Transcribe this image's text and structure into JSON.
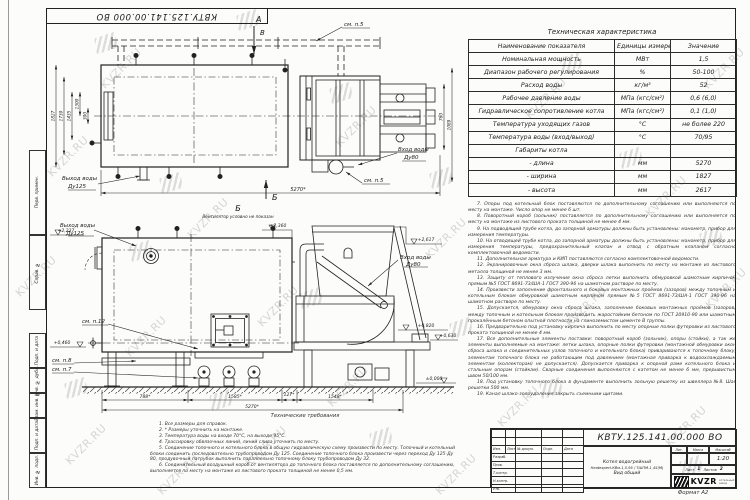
{
  "sheet": {
    "doc_number_top": "КВТУ.125.141.00.000 ВО",
    "format_note": "Формат А2"
  },
  "watermark": {
    "text": "KVZR.RU"
  },
  "margin_labels": [
    "Перв. примен.",
    "Справ. №",
    "Подп. и дата",
    "Инв. № дубл.",
    "Взам. инв. №",
    "Подп. и дата",
    "Инв. № подл."
  ],
  "spec_table": {
    "title": "Техническая характеристика",
    "headers": [
      "Наименование показателя",
      "Единицы измерения",
      "Значение"
    ],
    "rows": [
      [
        "Номинальная мощность",
        "МВт",
        "1,5"
      ],
      [
        "Диапазон рабочего регулирования",
        "%",
        "50-100"
      ],
      [
        "Расход воды",
        "кг/м³",
        "52"
      ],
      [
        "Рабочее давление воды",
        "МПа (кгс/см²)",
        "0,6 (6,0)"
      ],
      [
        "Гидравлическое сопротивление котла",
        "МПа (кгс/см²)",
        "0,1 (1,0)"
      ],
      [
        "Температура уходящих газов",
        "°С",
        "не более 220"
      ],
      [
        "Температура воды (вход/выход)",
        "°С",
        "70/95"
      ],
      [
        "Габариты котла",
        "",
        ""
      ],
      [
        "- длина",
        "мм",
        "5270"
      ],
      [
        "- ширина",
        "мм",
        "1827"
      ],
      [
        "- высота",
        "мм",
        "2617"
      ]
    ]
  },
  "notes_right": [
    "7. Опоры под котельный блок поставляются по дополнительному соглашению или выполняются по месту на монтаже. Число опор не менее 6 шт.",
    "8. Поворотный короб (зольник) поставляется по дополнительному соглашению или выполняется по месту на монтаже из листового проката толщиной не менее 4 мм.",
    "9. На подводящей трубе котла, до запорной арматуры должны быть установлены: манометр, прибор для измерения температуры.",
    "10. На отводящей трубе котла, до запорной арматуры должны быть установлены: манометр, прибор для измерения температуры, предохранительный клапан и отвод с обратным клапаном согласно комплектовочной ведомости.",
    "11. Дополнительная арматура и КИП поставляются согласно комплектовочной ведомости.",
    "12. Экранировочные окна сброса шлака, дверки шлака выполнить по месту на монтаже из листового металла толщиной не менее 3 мм.",
    "13. Защиту от теплового излучения окна сброса летки выполнить обмуровкой шамотным кирпичом прямым №5 ГОСТ 8691-73/ША-1 ГОСТ 390-96 на шамотном растворе по месту.",
    "14. Произвести заполнение фронтального и боковых монтажных проёмов (зазоров) между топочным и котельным блоком обмуровкой шамотным кирпичом прямым №5 ГОСТ 8691-73/ША-1 ГОСТ 390-96 на шамотном растворе по месту.",
    "15. Допускается, обмуровку окна сброса шлака, заполнение боковых монтажных проёмов (зазоров) между топочным и котельным блоком производить жаростойким бетоном по ГОСТ 20910-90 или шамотным прокалённым бетоном опытной плотности на глиноземистом цементе В группы.",
    "16. Предварительно под установку кирпича выполнить по месту опорные полки футеровки из листового проката толщиной не менее 4 мм.",
    "17. Все дополнительные элементы поставки: поворотный короб (зольник), опоры (стойки), а так же элементы выполняемые на монтаже: летки шлака, опорные полки футеровки (монтажной обмуровки окон сброса шлака и соединительных узлов топочного и котельного блока) привариваются к топочному блоку, элементам топочного блока не работающим под давлением (монтажная приварка к водоохлаждаемым элементам (коллекторам) не допускается). Допускается приварка к опорной раме котельного блока и стальным опорам (стойкам). Сварные соединения выполняются с катетом не менее 6 мм, прерывистым швом 50/100 мм.",
    "18. Под установку топочного блока в фундаменте выполнить зольную решетку из швеллера №8. Шаг решетки 500 мм.",
    "19. Канал шлако-золоудаления закрыть съемными щитами."
  ],
  "tech_req": {
    "title": "Технические требования",
    "items": [
      "1. Все размеры для справок.",
      "2. * Размеры уточнить на монтаже.",
      "3. Температура воды на входе 70°С, на выходе 95°С.",
      "4. Трассировку обвязочных линий, линий слива уточнить по месту.",
      "5. Соединение топочного и котельного блока в общую гидравлическую схему произвести по месту. Топочный и котельный блоки соединить последовательно трубопроводом Ду 125. Соединение топочного блока произвести через переход Ду 125-Ду 80, продувочный патрубок выполнить параллельно топочному блоку трубопроводом Ду 32.",
      "6. Соединительный воздушный короб от вентилятора до топочного блока поставляется по дополнительному соглашению, выполняется по месту на монтаже из листового проката толщиной не менее 0,5 мм."
    ]
  },
  "top_view": {
    "label_a": "А",
    "label_v": "В",
    "label_b": "Б",
    "see_p5": "см. п.5",
    "outlet_line1": "Выход воды",
    "outlet_line2": "Ду125",
    "inlet_line1": "Вход воды",
    "inlet_line2": "Ду80",
    "dim_left_1": "1827",
    "dim_left_2": "1730",
    "dim_left_3": "1435",
    "dim_left_4": "1300",
    "dim_left_5": "300",
    "dim_right_1": "760",
    "dim_right_2": "1089",
    "dim_length": "5270*"
  },
  "side_view": {
    "title": "Б",
    "subtitle": "Вентилятор условно не показан",
    "outlet_line1": "Выход воды",
    "outlet_line2": "Ду125",
    "inlet_line1": "Вход воды",
    "inlet_line2": "Ду80",
    "see_p12": "см. п.12",
    "see_p8": "см. п.8",
    "see_p7": "см. п.7",
    "elev_1": "+2,617",
    "elev_2": "+2,360",
    "elev_3": "+2,237",
    "elev_4": "+0,820",
    "elev_5": "+0,630",
    "elev_6": "+0,460",
    "elev_7": "±0,000",
    "dim_1": "788*",
    "dim_2": "1585*",
    "dim_3": "127*",
    "dim_4": "1548*",
    "dim_total": "5270*"
  },
  "title_block": {
    "doc_number": "КВТУ.125.141.00.000 ВО",
    "product_line1": "Котел водогрейный",
    "product_line2": "Heatexpert-КВм-1,5-95 / ТШПМ-1,45(М)",
    "view_name": "Вид общий",
    "col_izm": "Изм.",
    "col_list": "Лист",
    "col_doc": "№ докум.",
    "col_sign": "Подп.",
    "col_date": "Дата",
    "role_1": "Разраб.",
    "role_2": "Пров.",
    "role_3": "Т.контр.",
    "role_4": "Н.контр.",
    "role_5": "Утв.",
    "lit_header": "Лит.",
    "mass_header": "Масса",
    "scale_header": "Масштаб",
    "scale_value": "1:20",
    "sheet_label": "Лист",
    "sheet_value": "1",
    "sheets_label": "Листов",
    "sheets_value": "2",
    "logo_text": "KVZR",
    "logo_caption_1": "котельный",
    "logo_caption_2": "завод"
  }
}
